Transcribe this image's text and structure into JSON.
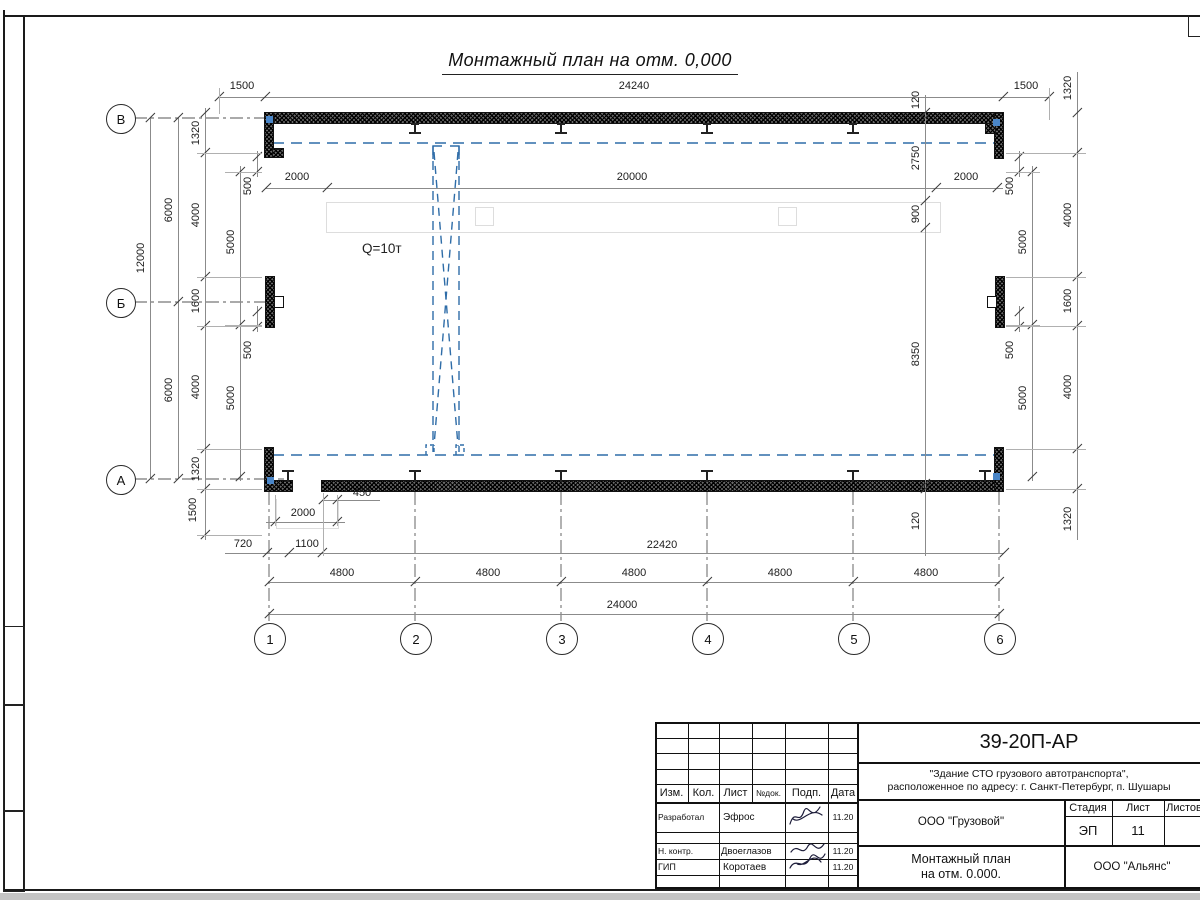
{
  "sheet": {
    "title": "Монтажный план на отм. 0,000",
    "crane_capacity": "Q=10т"
  },
  "colors": {
    "crane_blue": "#2f6da8",
    "line_black": "#1a1a1a",
    "dim_gray": "#8b8b8b"
  },
  "axis_labels": {
    "columns": [
      "1",
      "2",
      "3",
      "4",
      "5",
      "6"
    ],
    "rows": [
      "В",
      "Б",
      "А"
    ]
  },
  "dim_labels": [
    {
      "t": "1500",
      "x": 242,
      "y": 86
    },
    {
      "t": "24240",
      "x": 634,
      "y": 86
    },
    {
      "t": "1500",
      "x": 1026,
      "y": 86
    },
    {
      "t": "2000",
      "x": 297,
      "y": 177
    },
    {
      "t": "20000",
      "x": 632,
      "y": 177
    },
    {
      "t": "2000",
      "x": 966,
      "y": 177
    },
    {
      "t": "450",
      "x": 362,
      "y": 493
    },
    {
      "t": "2000",
      "x": 303,
      "y": 513
    },
    {
      "t": "720",
      "x": 243,
      "y": 544
    },
    {
      "t": "1100",
      "x": 307,
      "y": 544
    },
    {
      "t": "22420",
      "x": 662,
      "y": 545
    },
    {
      "t": "4800",
      "x": 342,
      "y": 573
    },
    {
      "t": "4800",
      "x": 488,
      "y": 573
    },
    {
      "t": "4800",
      "x": 634,
      "y": 573
    },
    {
      "t": "4800",
      "x": 780,
      "y": 573
    },
    {
      "t": "4800",
      "x": 926,
      "y": 573
    },
    {
      "t": "24000",
      "x": 622,
      "y": 605
    },
    {
      "t": "12000",
      "x": 141,
      "y": 258,
      "r": 1
    },
    {
      "t": "6000",
      "x": 169,
      "y": 210,
      "r": 1
    },
    {
      "t": "6000",
      "x": 169,
      "y": 390,
      "r": 1
    },
    {
      "t": "1320",
      "x": 196,
      "y": 133,
      "r": 1
    },
    {
      "t": "4000",
      "x": 196,
      "y": 215,
      "r": 1
    },
    {
      "t": "1600",
      "x": 196,
      "y": 301,
      "r": 1
    },
    {
      "t": "4000",
      "x": 196,
      "y": 387,
      "r": 1
    },
    {
      "t": "1320",
      "x": 196,
      "y": 469,
      "r": 1
    },
    {
      "t": "1500",
      "x": 193,
      "y": 510,
      "r": 1
    },
    {
      "t": "5000",
      "x": 231,
      "y": 242,
      "r": 1
    },
    {
      "t": "5000",
      "x": 231,
      "y": 398,
      "r": 1
    },
    {
      "t": "500",
      "x": 248,
      "y": 186,
      "r": 1
    },
    {
      "t": "500",
      "x": 248,
      "y": 350,
      "r": 1
    },
    {
      "t": "500",
      "x": 1010,
      "y": 186,
      "r": 1
    },
    {
      "t": "500",
      "x": 1010,
      "y": 350,
      "r": 1
    },
    {
      "t": "5000",
      "x": 1023,
      "y": 242,
      "r": 1
    },
    {
      "t": "5000",
      "x": 1023,
      "y": 398,
      "r": 1
    },
    {
      "t": "1320",
      "x": 1068,
      "y": 88,
      "r": 1
    },
    {
      "t": "4000",
      "x": 1068,
      "y": 215,
      "r": 1
    },
    {
      "t": "1600",
      "x": 1068,
      "y": 301,
      "r": 1
    },
    {
      "t": "4000",
      "x": 1068,
      "y": 387,
      "r": 1
    },
    {
      "t": "1320",
      "x": 1068,
      "y": 519,
      "r": 1
    },
    {
      "t": "120",
      "x": 916,
      "y": 100,
      "r": 1
    },
    {
      "t": "2750",
      "x": 916,
      "y": 158,
      "r": 1
    },
    {
      "t": "900",
      "x": 916,
      "y": 214,
      "r": 1
    },
    {
      "t": "8350",
      "x": 916,
      "y": 354,
      "r": 1
    },
    {
      "t": "120",
      "x": 916,
      "y": 521,
      "r": 1
    }
  ],
  "title_block": {
    "doc_number": "39-20П-АР",
    "project_line1": "\"Здание СТО грузового автотранспорта\",",
    "project_line2": "расположенное по адресу: г. Санкт-Петербург, п. Шушары",
    "col_headers": [
      "Изм.",
      "Кол.",
      "Лист",
      "№док.",
      "Подп.",
      "Дата"
    ],
    "rows": [
      {
        "role": "Разработал",
        "name": "Эфрос",
        "date": "11.20"
      },
      {
        "role": "Н. контр.",
        "name": "Двоеглазов",
        "date": "11.20"
      },
      {
        "role": "ГИП",
        "name": "Коротаев",
        "date": "11.20"
      }
    ],
    "org": "ООО \"Грузовой\"",
    "company": "ООО \"Альянс\"",
    "stage_label": "Стадия",
    "stage_value": "ЭП",
    "sheet_label": "Лист",
    "sheet_value": "11",
    "sheets_label": "Листов",
    "name_line1": "Монтажный план",
    "name_line2": "на отм. 0.000."
  }
}
